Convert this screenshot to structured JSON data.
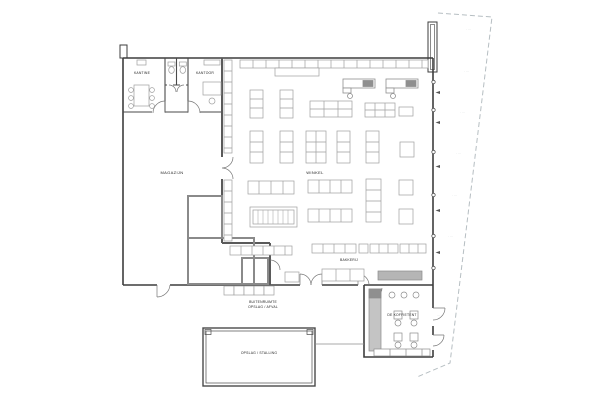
{
  "drawing": {
    "title": "supermarket-floor-plan",
    "rooms": {
      "kantine": "KANTINE",
      "kantoor": "KANTOOR",
      "magazijn": "MAGAZIJN",
      "winkel": "WINKEL",
      "bakkerij": "BAKKERIJ",
      "koffietent": "DE KOFFIETENT",
      "buitenruimte_line1": "BUITENRUIMTE",
      "buitenruimte_line2": "OPSLAG / AFVAL",
      "bijgebouw": "OPSLAG / STALLING"
    },
    "boundary_marks": [
      "· ···",
      "· ···",
      "· ···",
      "· ···",
      "· ···",
      "· ···",
      "···"
    ],
    "colors": {
      "wall": "#3d3d3d",
      "interior_wall": "#6e6e6e",
      "cold_room_wall": "#8a8a8a",
      "fixture": "#9f9f9f",
      "counter_fill": "#b5b5b5",
      "register_fill": "#8f8f8f",
      "boundary": "#b6bec2",
      "paper": "#ffffff"
    }
  }
}
